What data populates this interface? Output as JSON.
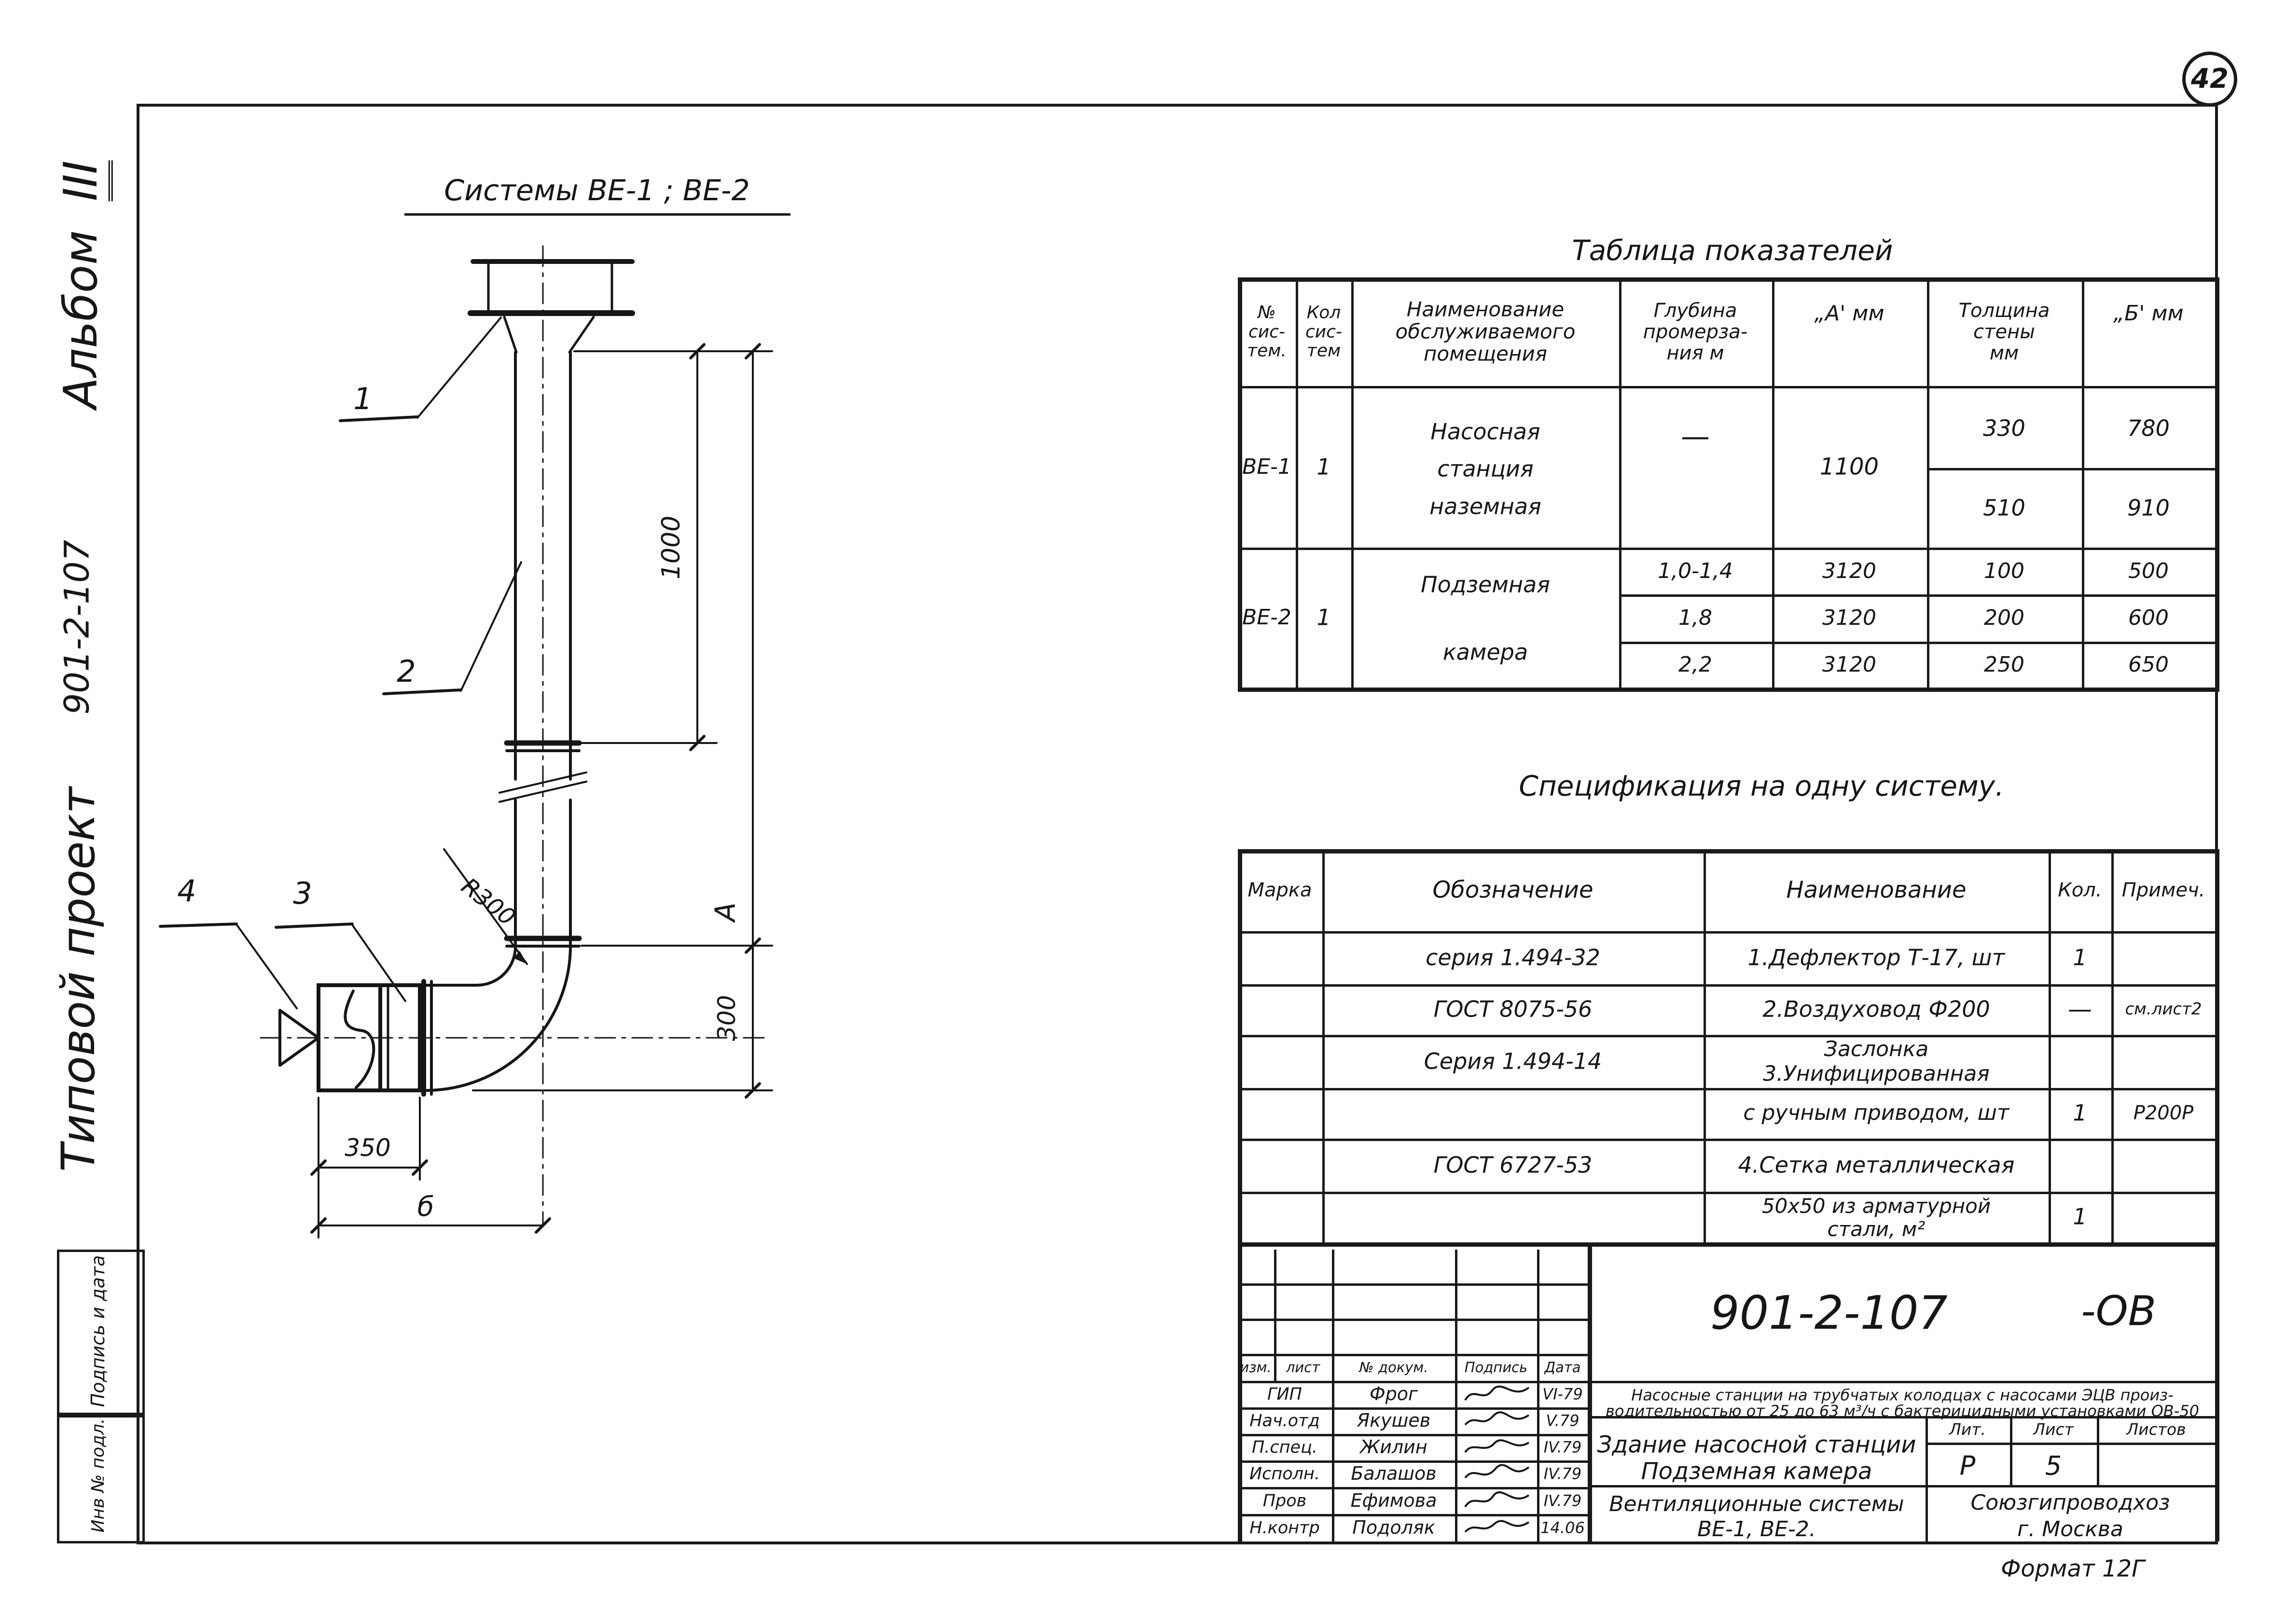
{
  "page": {
    "sheet_number": "42",
    "format_note": "Формат 12Г"
  },
  "margin": {
    "album_word": "Альбом",
    "album_num": "III",
    "project_code": "901-2-107",
    "project_name": "Типовой проект",
    "box_signature": "Подпись и дата",
    "box_inventory": "Инв № подл."
  },
  "drawing": {
    "title": "Системы  ВЕ-1 ; ВЕ-2",
    "callout_1": "1",
    "callout_2": "2",
    "callout_3": "3",
    "callout_4": "4",
    "dim_1000": "1000",
    "dim_a": "А",
    "dim_300": "300",
    "dim_350": "350",
    "dim_b": "б",
    "dim_radius": "R300"
  },
  "table1": {
    "title": "Таблица    показателей",
    "h_num": [
      "№",
      "сис-",
      "тем."
    ],
    "h_qty": [
      "Кол",
      "сис-",
      "тем"
    ],
    "h_room": [
      "Наименование",
      "обслуживаемого",
      "помещения"
    ],
    "h_depth": [
      "Глубина",
      "промерза-",
      "ния м"
    ],
    "h_a": "„А'  мм",
    "h_wall": [
      "Толщина",
      "стены",
      "мм"
    ],
    "h_b": "„Б'  мм",
    "r1": {
      "num": "ВЕ-1",
      "qty": "1",
      "room": [
        "Насосная",
        "станция",
        "наземная"
      ],
      "depth": "—",
      "a": "1100",
      "wall1": "330",
      "b1": "780",
      "wall2": "510",
      "b2": "910"
    },
    "r2": {
      "num": "ВЕ-2",
      "qty": "1",
      "room": [
        "Подземная",
        "камера"
      ],
      "s1": {
        "depth": "1,0-1,4",
        "a": "3120",
        "wall": "100",
        "b": "500"
      },
      "s2": {
        "depth": "1,8",
        "a": "3120",
        "wall": "200",
        "b": "600"
      },
      "s3": {
        "depth": "2,2",
        "a": "3120",
        "wall": "250",
        "b": "650"
      }
    }
  },
  "spec": {
    "title": "Спецификация    на одну систему.",
    "h_mark": "Марка",
    "h_code": "Обозначение",
    "h_name": "Наименование",
    "h_qty": "Кол.",
    "h_note": "Примеч.",
    "r1": {
      "code": "серия   1.494-32",
      "name": "1.Дефлектор  Т-17, шт",
      "qty": "1"
    },
    "r2": {
      "code": "ГОСТ   8075-56",
      "name": "2.Воздуховод  Ф200",
      "qty": "—",
      "note": "см.лист2"
    },
    "r3": {
      "code": "Серия  1.494-14",
      "name1": "Заслонка",
      "name2": "3.Унифицированная"
    },
    "r4": {
      "name": "с ручным приводом, шт",
      "qty": "1",
      "note": "Р200Р"
    },
    "r5": {
      "code": "ГОСТ  6727-53",
      "name": "4.Сетка  металлическая"
    },
    "r6": {
      "name1": "50х50 из арматурной",
      "name2": "стали, м²",
      "qty": "1"
    }
  },
  "titleblock": {
    "doc_code": "901-2-107",
    "doc_suffix": "-ОВ",
    "desc1": "Насосные станции на трубчатых колодцах с насосами ЭЦВ произ-",
    "desc2": "водительностью от 25 до 63 м³/ч с бактерицидными установками ОВ-50",
    "col_izm": "изм.",
    "col_list": "лист",
    "col_doc": "№ докум.",
    "col_sign": "Подпись",
    "col_date": "Дата",
    "rows": [
      {
        "role": "ГИП",
        "name": "Фрог",
        "date": "VI-79"
      },
      {
        "role": "Нач.отд",
        "name": "Якушев",
        "date": "V.79"
      },
      {
        "role": "П.спец.",
        "name": "Жилин",
        "date": "IV.79"
      },
      {
        "role": "Исполн.",
        "name": "Балашов",
        "date": "IV.79"
      },
      {
        "role": "Пров",
        "name": "Ефимова",
        "date": "IV.79"
      },
      {
        "role": "Н.контр",
        "name": "Подоляк",
        "date": "14.06"
      }
    ],
    "title1": "Здание насосной станции",
    "title2": "Подземная камера",
    "subtitle1": "Вентиляционные системы",
    "subtitle2": "ВЕ-1, ВЕ-2.",
    "lit_label": "Лит.",
    "list_label": "Лист",
    "listov_label": "Листов",
    "lit_value": "Р",
    "list_value": "5",
    "org1": "Союзгипроводхоз",
    "org2": "г. Москва"
  }
}
